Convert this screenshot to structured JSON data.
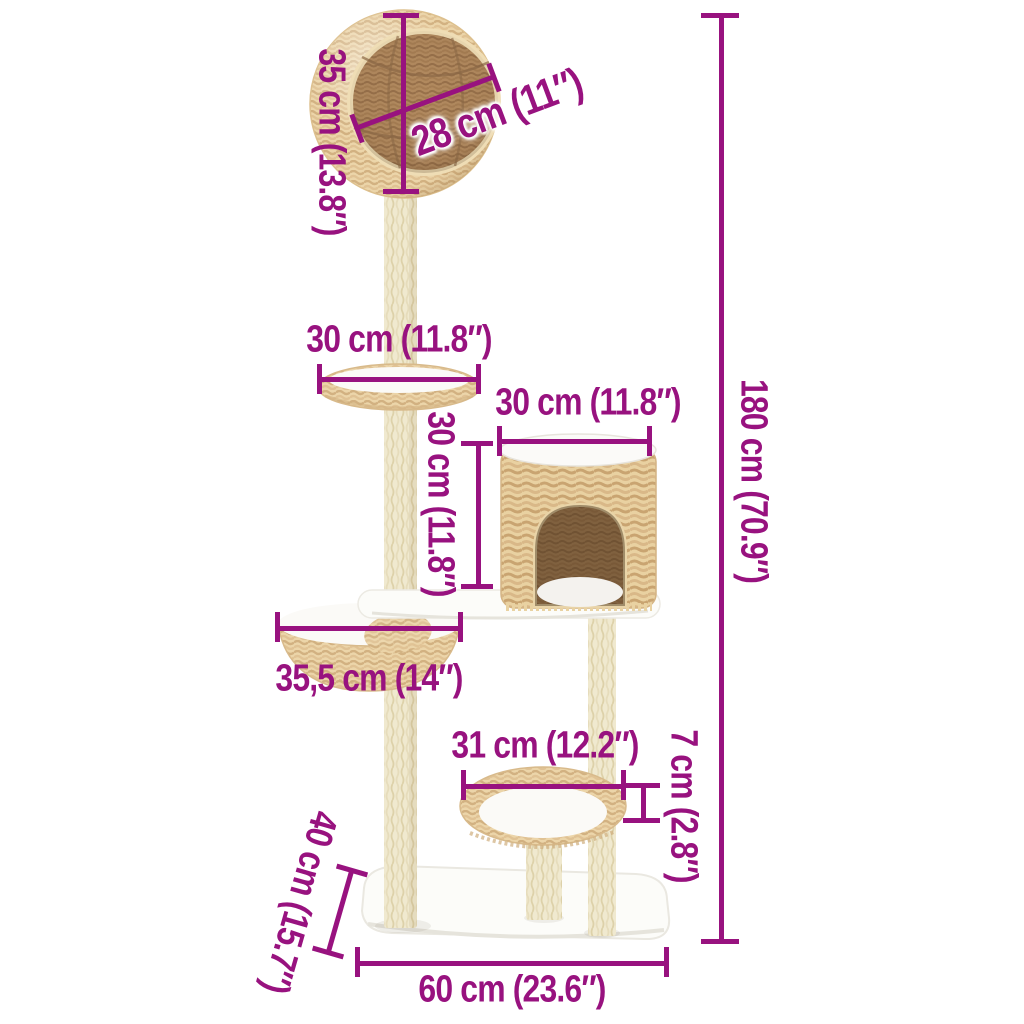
{
  "diagram": {
    "kind": "product-dimension-diagram"
  },
  "dimensions": {
    "ball_height": {
      "label": "35 cm (13.8″)"
    },
    "ball_opening": {
      "label": "28 cm (11″)"
    },
    "top_tray_width": {
      "label": "30 cm (11.8″)"
    },
    "house_width": {
      "label": "30 cm (11.8″)"
    },
    "house_height": {
      "label": "30 cm (11.8″)"
    },
    "total_height": {
      "label": "180 cm (70.9″)"
    },
    "basket_width": {
      "label": "35,5 cm (14″)"
    },
    "bottom_bed_width": {
      "label": "31 cm (12.2″)"
    },
    "bottom_bed_height": {
      "label": "7 cm (2.8″)"
    },
    "base_depth": {
      "label": "40 cm (15.7″)"
    },
    "base_width": {
      "label": "60 cm (23.6″)"
    }
  },
  "colors": {
    "accent": "#98127f",
    "weave_light": "#ecd5a9",
    "weave_shadow": "#d2b181",
    "weave_interior": "#b28a5f",
    "pole": "#f0e9cf",
    "platform_white": "#fcfcf9",
    "background": "#ffffff"
  }
}
